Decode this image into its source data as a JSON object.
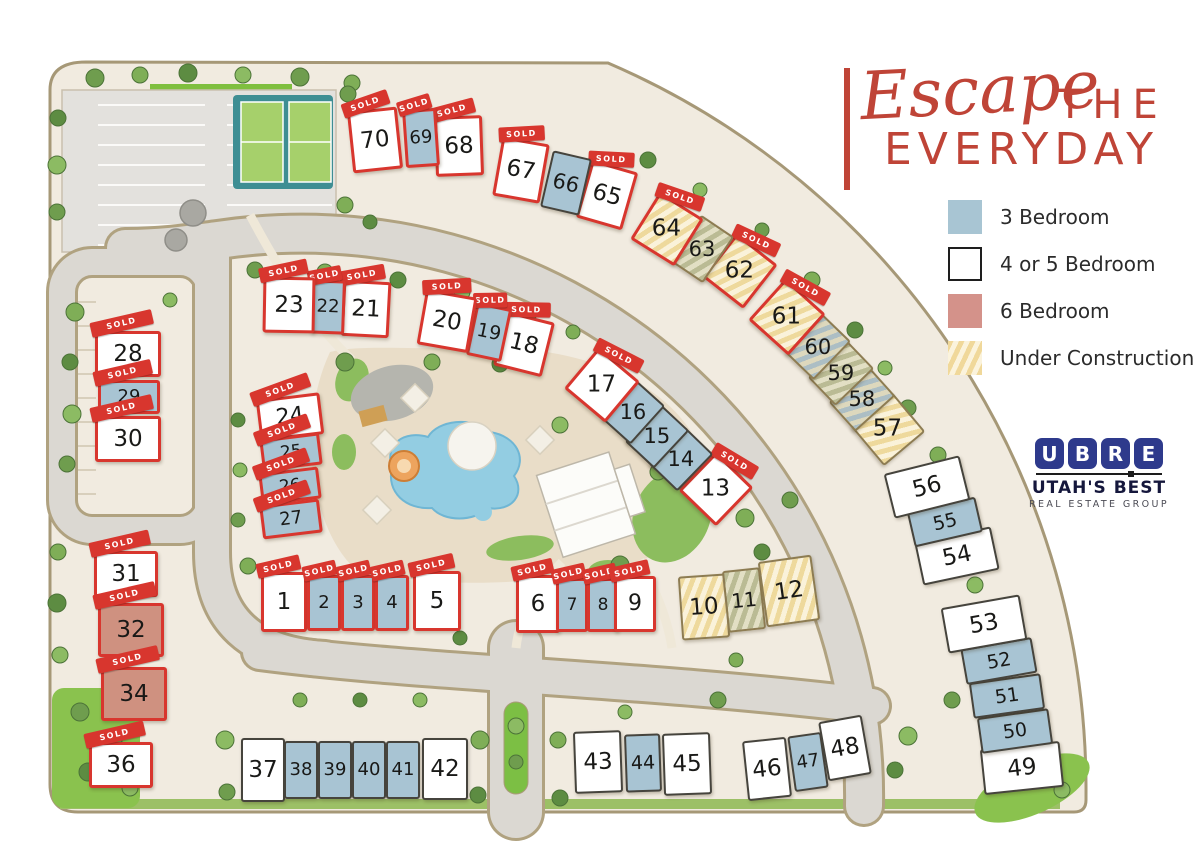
{
  "title": {
    "script": "Escape",
    "the": "THE",
    "everyday": "EVERYDAY",
    "accent_color": "#bf4437"
  },
  "sold_label": "SOLD",
  "legend": {
    "items": [
      {
        "label": "3 Bedroom",
        "type": "3",
        "color": "#a8c5d3"
      },
      {
        "label": "4 or 5 Bedroom",
        "type": "45",
        "color": "#ffffff"
      },
      {
        "label": "6 Bedroom",
        "type": "6",
        "color": "#d4928a"
      },
      {
        "label": "Under Construction",
        "type": "uc",
        "color": "#f0d89a"
      }
    ]
  },
  "logo": {
    "letters": [
      "U",
      "B",
      "R",
      "E"
    ],
    "line1": "UTAH'S BEST",
    "line2": "REAL ESTATE GROUP",
    "color": "#2e3a8c"
  },
  "colors": {
    "three_bedroom": "#a8c4d3",
    "four_five_bedroom": "#ffffff",
    "six_bedroom": "#cf9180",
    "sold_red": "#d8362e",
    "under_construction": "#eed99c"
  },
  "lots": [
    {
      "num": 1,
      "x": 284,
      "y": 602,
      "w": 46,
      "h": 60,
      "rot": 0,
      "type": "45",
      "sold": true
    },
    {
      "num": 2,
      "x": 324,
      "y": 603,
      "w": 34,
      "h": 56,
      "rot": 0,
      "type": "3",
      "sold": true
    },
    {
      "num": 3,
      "x": 358,
      "y": 603,
      "w": 34,
      "h": 56,
      "rot": 0,
      "type": "3",
      "sold": true
    },
    {
      "num": 4,
      "x": 392,
      "y": 603,
      "w": 34,
      "h": 56,
      "rot": 0,
      "type": "3",
      "sold": true
    },
    {
      "num": 5,
      "x": 437,
      "y": 601,
      "w": 48,
      "h": 60,
      "rot": 0,
      "type": "45",
      "sold": true
    },
    {
      "num": 6,
      "x": 538,
      "y": 604,
      "w": 44,
      "h": 58,
      "rot": 0,
      "type": "45",
      "sold": true
    },
    {
      "num": 7,
      "x": 572,
      "y": 605,
      "w": 32,
      "h": 54,
      "rot": 0,
      "type": "3",
      "sold": true
    },
    {
      "num": 8,
      "x": 603,
      "y": 605,
      "w": 32,
      "h": 54,
      "rot": 0,
      "type": "3",
      "sold": true
    },
    {
      "num": 9,
      "x": 635,
      "y": 604,
      "w": 42,
      "h": 56,
      "rot": 0,
      "type": "45",
      "sold": true
    },
    {
      "num": 10,
      "x": 704,
      "y": 607,
      "w": 48,
      "h": 64,
      "rot": -4,
      "type": "45",
      "uc": "gold"
    },
    {
      "num": 11,
      "x": 744,
      "y": 600,
      "w": 38,
      "h": 62,
      "rot": -6,
      "type": "3",
      "uc": "olive"
    },
    {
      "num": 12,
      "x": 789,
      "y": 591,
      "w": 54,
      "h": 66,
      "rot": -8,
      "type": "45",
      "uc": "gold"
    },
    {
      "num": 13,
      "x": 716,
      "y": 489,
      "w": 52,
      "h": 54,
      "rot": 44,
      "type": "45",
      "sold": true
    },
    {
      "num": 14,
      "x": 681,
      "y": 459,
      "w": 40,
      "h": 52,
      "rot": 44,
      "type": "3"
    },
    {
      "num": 15,
      "x": 657,
      "y": 436,
      "w": 40,
      "h": 52,
      "rot": 43,
      "type": "3"
    },
    {
      "num": 16,
      "x": 633,
      "y": 412,
      "w": 40,
      "h": 52,
      "rot": 42,
      "type": "3"
    },
    {
      "num": 17,
      "x": 602,
      "y": 385,
      "w": 54,
      "h": 54,
      "rot": 40,
      "type": "45",
      "sold": true
    },
    {
      "num": 18,
      "x": 524,
      "y": 344,
      "w": 50,
      "h": 56,
      "rot": 14,
      "type": "45",
      "sold": true
    },
    {
      "num": 19,
      "x": 489,
      "y": 332,
      "w": 36,
      "h": 54,
      "rot": 12,
      "type": "3",
      "sold": true
    },
    {
      "num": 20,
      "x": 447,
      "y": 321,
      "w": 52,
      "h": 56,
      "rot": 10,
      "type": "45",
      "sold": true
    },
    {
      "num": 21,
      "x": 366,
      "y": 309,
      "w": 48,
      "h": 56,
      "rot": 3,
      "type": "45",
      "sold": true
    },
    {
      "num": 22,
      "x": 328,
      "y": 307,
      "w": 34,
      "h": 54,
      "rot": 2,
      "type": "3",
      "sold": true
    },
    {
      "num": 23,
      "x": 289,
      "y": 305,
      "w": 52,
      "h": 56,
      "rot": 1,
      "type": "45",
      "sold": true
    },
    {
      "num": 24,
      "x": 290,
      "y": 417,
      "w": 64,
      "h": 42,
      "rot": -7,
      "type": "45",
      "sold": true
    },
    {
      "num": 25,
      "x": 291,
      "y": 452,
      "w": 60,
      "h": 32,
      "rot": -7,
      "type": "3",
      "sold": true
    },
    {
      "num": 26,
      "x": 290,
      "y": 486,
      "w": 60,
      "h": 32,
      "rot": -7,
      "type": "3",
      "sold": true
    },
    {
      "num": 27,
      "x": 291,
      "y": 519,
      "w": 60,
      "h": 34,
      "rot": -7,
      "type": "3",
      "sold": true
    },
    {
      "num": 28,
      "x": 128,
      "y": 354,
      "w": 66,
      "h": 46,
      "rot": 0,
      "type": "45",
      "sold": true
    },
    {
      "num": 29,
      "x": 129,
      "y": 397,
      "w": 62,
      "h": 34,
      "rot": 0,
      "type": "3",
      "sold": true
    },
    {
      "num": 30,
      "x": 128,
      "y": 439,
      "w": 66,
      "h": 46,
      "rot": 0,
      "type": "45",
      "sold": true
    },
    {
      "num": 31,
      "x": 126,
      "y": 574,
      "w": 64,
      "h": 46,
      "rot": 0,
      "type": "45",
      "sold": true
    },
    {
      "num": 32,
      "x": 131,
      "y": 630,
      "w": 66,
      "h": 54,
      "rot": 0,
      "type": "6",
      "sold": true
    },
    {
      "num": 34,
      "x": 134,
      "y": 694,
      "w": 66,
      "h": 54,
      "rot": 0,
      "type": "6",
      "sold": true
    },
    {
      "num": 36,
      "x": 121,
      "y": 765,
      "w": 64,
      "h": 46,
      "rot": 0,
      "type": "45",
      "sold": true
    },
    {
      "num": 37,
      "x": 263,
      "y": 770,
      "w": 44,
      "h": 64,
      "rot": 0,
      "type": "45"
    },
    {
      "num": 38,
      "x": 301,
      "y": 770,
      "w": 34,
      "h": 58,
      "rot": 0,
      "type": "3"
    },
    {
      "num": 39,
      "x": 335,
      "y": 770,
      "w": 34,
      "h": 58,
      "rot": 0,
      "type": "3"
    },
    {
      "num": 40,
      "x": 369,
      "y": 770,
      "w": 34,
      "h": 58,
      "rot": 0,
      "type": "3"
    },
    {
      "num": 41,
      "x": 403,
      "y": 770,
      "w": 34,
      "h": 58,
      "rot": 0,
      "type": "3"
    },
    {
      "num": 42,
      "x": 445,
      "y": 769,
      "w": 46,
      "h": 62,
      "rot": 0,
      "type": "45"
    },
    {
      "num": 43,
      "x": 598,
      "y": 762,
      "w": 48,
      "h": 62,
      "rot": -2,
      "type": "45"
    },
    {
      "num": 44,
      "x": 643,
      "y": 763,
      "w": 36,
      "h": 58,
      "rot": -2,
      "type": "3"
    },
    {
      "num": 45,
      "x": 687,
      "y": 764,
      "w": 48,
      "h": 62,
      "rot": -2,
      "type": "45"
    },
    {
      "num": 46,
      "x": 767,
      "y": 769,
      "w": 44,
      "h": 60,
      "rot": -6,
      "type": "45"
    },
    {
      "num": 47,
      "x": 808,
      "y": 762,
      "w": 34,
      "h": 56,
      "rot": -8,
      "type": "3"
    },
    {
      "num": 48,
      "x": 845,
      "y": 748,
      "w": 44,
      "h": 60,
      "rot": -10,
      "type": "45"
    },
    {
      "num": 49,
      "x": 1022,
      "y": 768,
      "w": 80,
      "h": 46,
      "rot": -6,
      "type": "45"
    },
    {
      "num": 50,
      "x": 1015,
      "y": 731,
      "w": 72,
      "h": 36,
      "rot": -8,
      "type": "3"
    },
    {
      "num": 51,
      "x": 1007,
      "y": 696,
      "w": 72,
      "h": 36,
      "rot": -8,
      "type": "3"
    },
    {
      "num": 52,
      "x": 999,
      "y": 661,
      "w": 72,
      "h": 36,
      "rot": -10,
      "type": "3"
    },
    {
      "num": 53,
      "x": 984,
      "y": 624,
      "w": 80,
      "h": 46,
      "rot": -10,
      "type": "45"
    },
    {
      "num": 54,
      "x": 957,
      "y": 556,
      "w": 78,
      "h": 44,
      "rot": -12,
      "type": "45"
    },
    {
      "num": 55,
      "x": 945,
      "y": 522,
      "w": 70,
      "h": 36,
      "rot": -13,
      "type": "3"
    },
    {
      "num": 56,
      "x": 927,
      "y": 487,
      "w": 78,
      "h": 46,
      "rot": -14,
      "type": "45"
    },
    {
      "num": 57,
      "x": 888,
      "y": 429,
      "w": 52,
      "h": 54,
      "rot": 50,
      "type": "45",
      "uc": "gold"
    },
    {
      "num": 58,
      "x": 862,
      "y": 399,
      "w": 40,
      "h": 54,
      "rot": 48,
      "type": "3",
      "uc": "blue"
    },
    {
      "num": 59,
      "x": 841,
      "y": 373,
      "w": 40,
      "h": 54,
      "rot": 46,
      "type": "3",
      "uc": "olive"
    },
    {
      "num": 60,
      "x": 818,
      "y": 347,
      "w": 40,
      "h": 54,
      "rot": 44,
      "type": "3",
      "uc": "blue"
    },
    {
      "num": 61,
      "x": 787,
      "y": 317,
      "w": 54,
      "h": 56,
      "rot": 42,
      "type": "45",
      "uc": "gold",
      "sold": true
    },
    {
      "num": 62,
      "x": 740,
      "y": 271,
      "w": 52,
      "h": 56,
      "rot": 38,
      "type": "45",
      "uc": "gold",
      "sold": true
    },
    {
      "num": 63,
      "x": 702,
      "y": 249,
      "w": 40,
      "h": 56,
      "rot": 34,
      "type": "3",
      "uc": "olive"
    },
    {
      "num": 64,
      "x": 667,
      "y": 229,
      "w": 52,
      "h": 56,
      "rot": 32,
      "type": "45",
      "uc": "gold",
      "sold": true
    },
    {
      "num": 65,
      "x": 607,
      "y": 195,
      "w": 48,
      "h": 60,
      "rot": 16,
      "type": "45",
      "sold": true
    },
    {
      "num": 66,
      "x": 566,
      "y": 183,
      "w": 40,
      "h": 58,
      "rot": 13,
      "type": "3"
    },
    {
      "num": 67,
      "x": 521,
      "y": 170,
      "w": 48,
      "h": 60,
      "rot": 10,
      "type": "45",
      "sold": true
    },
    {
      "num": 68,
      "x": 459,
      "y": 146,
      "w": 48,
      "h": 60,
      "rot": -2,
      "type": "45",
      "sold": true
    },
    {
      "num": 69,
      "x": 421,
      "y": 138,
      "w": 34,
      "h": 58,
      "rot": -4,
      "type": "3",
      "sold": true
    },
    {
      "num": 70,
      "x": 375,
      "y": 140,
      "w": 50,
      "h": 62,
      "rot": -6,
      "type": "45",
      "sold": true
    }
  ]
}
